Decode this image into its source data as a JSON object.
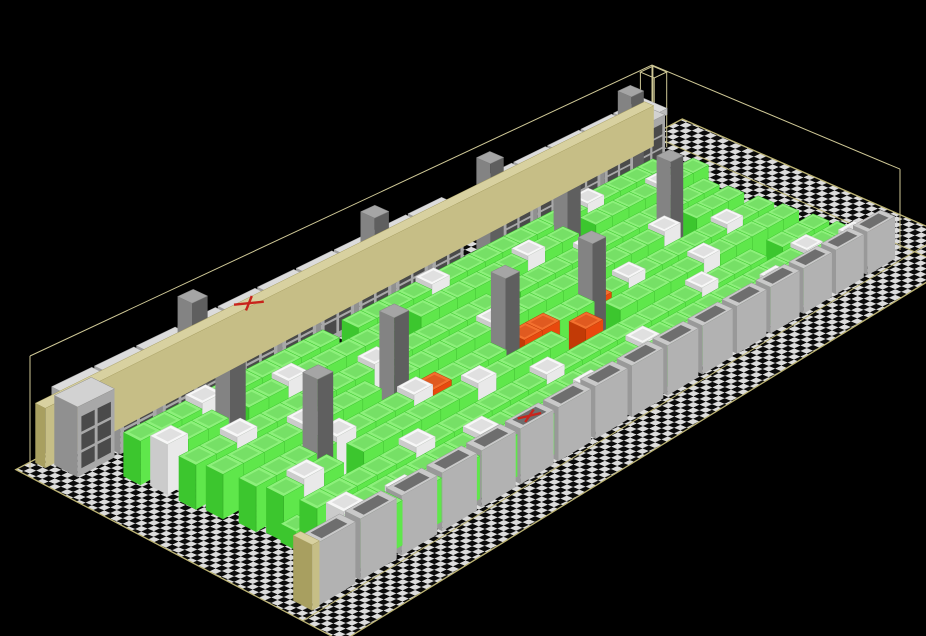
{
  "meta": {
    "view_type": "isometric-3d-room-model",
    "subject": "data-center machine room with rack rows, perimeter cooling units, building columns and raised floor"
  },
  "canvas": {
    "width": 926,
    "height": 636,
    "background": "#000000"
  },
  "scene": {
    "projection": {
      "floor_quad": {
        "c00": [
          30,
          468
        ],
        "c10": [
          652,
          140
        ],
        "c11": [
          900,
          250
        ],
        "c01": [
          300,
          610
        ]
      },
      "tiles": {
        "u": 34,
        "v": 14
      },
      "height_exponent": 2.5
    },
    "palette": {
      "wireframe": "#CFC896",
      "floor_edge": "#BDB474",
      "check_light": "#DCDCDC",
      "check_dark": "#0B0B0B",
      "failure_red": "#C8241C",
      "tan_wall": {
        "top": "#D8D1A0",
        "front": "#C6BE86",
        "side": "#A89F60"
      },
      "crac": {
        "top": "#D2D2D2",
        "front": "#A8A8A8",
        "side": "#909090",
        "window": "#4A4A4A",
        "cap_top": "#DCDCDC",
        "cap_front": "#BCBCBC",
        "cap_side": "#A2A2A2"
      },
      "cabinet": {
        "top": "#C9C9C9",
        "front": "#B2B2B2",
        "side": "#999999",
        "inset": "#6E6E6E"
      },
      "pillar": {
        "top": "#A5A5A5",
        "front": "#5F5F5F",
        "side": "#838383"
      },
      "rack_green": {
        "top": "#8DF07B",
        "front": "#5FE74B",
        "side": "#3CC62E",
        "inset": "#76E066",
        "seam": "#35B028"
      },
      "rack_white": {
        "top": "#F7F7F7",
        "front": "#E9E9E9",
        "side": "#CBCBCB",
        "inset": "#E0E0E0",
        "seam": "#BDBDBD"
      },
      "rack_orange": {
        "top": "#F3702F",
        "front": "#E8490E",
        "side": "#C23A06",
        "inset": "#E05A20",
        "seam": "#B03504"
      }
    },
    "floor": {
      "u_min": -0.4,
      "u_max": 36.3,
      "v_min": -0.3,
      "v_max": 16.5,
      "pattern_matrix": [
        6.3,
        -3.0,
        6.2,
        2.6,
        30,
        468
      ],
      "inner_line_v": 14.55,
      "inner_line_u": 34.3
    },
    "wireframe": {
      "wall_height": 112,
      "corner_column": {
        "u1": 33.15,
        "v1": 0.1,
        "u2": 33.95,
        "v2": 0.9
      }
    },
    "back_wall": {
      "panel": {
        "u1": 0.35,
        "v1": -0.12,
        "u2": 33.65,
        "v2": 0.42,
        "h": 60
      },
      "units": {
        "count": 16,
        "u_start": 0.7,
        "pitch": 2.03,
        "width": 1.75,
        "v1": 0.5,
        "v2": 1.75,
        "body_h": 70,
        "cap_h": 9,
        "missing_index": 10,
        "failed_index": 4
      }
    },
    "front_wall": {
      "end_panel": {
        "u1": 0.25,
        "v1": 13.4,
        "u2": 0.6,
        "v2": 14.35,
        "h": 60
      },
      "units": {
        "count": 16,
        "u_start": 0.6,
        "pitch": 2.06,
        "width": 1.8,
        "v1": 13.5,
        "v2": 14.3,
        "h": 58,
        "failed_index": 5
      }
    },
    "pillars": {
      "half_size": 0.39,
      "height": 125,
      "positions": [
        [
          6.4,
          1.6
        ],
        [
          15.9,
          1.6
        ],
        [
          22.4,
          1.6
        ],
        [
          30.9,
          1.6
        ],
        [
          5.6,
          4.5
        ],
        [
          24.2,
          4.2
        ],
        [
          10.7,
          7.9
        ],
        [
          27.6,
          6.8
        ],
        [
          5.5,
          9.2
        ],
        [
          15.8,
          8.8
        ],
        [
          20.2,
          9.3
        ]
      ]
    },
    "racks": {
      "depth": 0.9,
      "heights": {
        "G": 44,
        "W": 50,
        "O": 44,
        "S": 18
      },
      "color_keys": {
        "G": "rack_green",
        "W": "rack_white",
        "O": "rack_orange",
        "S": "rack_green"
      },
      "rows": [
        {
          "v": 2.95,
          "u0": 1.8,
          "slots": "GGGWGGGGGG.GGGGWGGGGGGGGWGGGG"
        },
        {
          "v": 4.15,
          "u0": 2.0,
          "slots": "WGG.GGWGGGGG.GGGGGGWGG.GGGGWGG"
        },
        {
          "v": 5.65,
          "u0": 2.0,
          "slots": "GGWGGGGGGWGGGGGG.GGGGWGGGGGGG"
        },
        {
          "v": 6.85,
          "u0": 2.2,
          "slots": "GGGGWGGG.GGGGGWGGGGGGGGGW.GGG"
        },
        {
          "v": 8.35,
          "u0": 2.4,
          "slots": "GGGGWGGGWOGGG.OOGGOGWGGGGGWGG"
        },
        {
          "v": 9.55,
          "u0": 2.6,
          "slots": "GWG.GGGGGGWGGGG.O.GGGGGWGGGGG"
        },
        {
          "v": 11.05,
          "u0": 2.8,
          "slots": "GGGGGWGGGGGGWGGGGGGGGWGGG.GGG"
        },
        {
          "v": 12.2,
          "u0": 3.0,
          "slots": "WGGGGGGWGGGGGGGGWGGGGGGGGGWGG"
        },
        {
          "v": 12.95,
          "u0": 3.2,
          "slots": "GGWGGGGGGGGGWGGGGGGGGGGWGGGGWO"
        }
      ]
    },
    "loose_boxes": [
      {
        "u": 2.5,
        "v": 10.4,
        "h": 18,
        "key": "rack_green"
      },
      {
        "u": 13.5,
        "v": 2.3,
        "h": 14,
        "key": "rack_orange"
      },
      {
        "u": 19.3,
        "v": 1.3,
        "h": 14,
        "key": "rack_orange"
      }
    ],
    "failure_marks": {
      "stroke_width": 2.4,
      "shrink": 0.52
    }
  }
}
